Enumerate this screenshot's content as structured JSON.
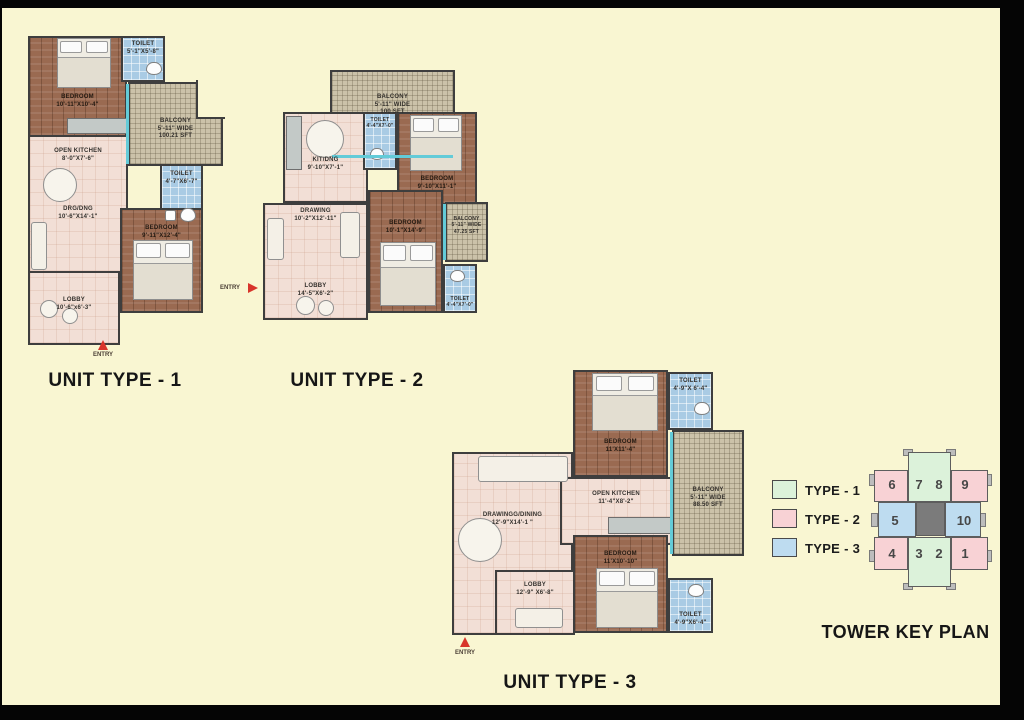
{
  "colors": {
    "bg": "#F9F6D2",
    "frame": "#050505",
    "wall": "#3E3E3E",
    "wood": "#9A6A51",
    "pink_floor": "#F2DFD6",
    "blue_floor": "#A9CBE4",
    "balcony": "#CBC2A9",
    "window_teal": "#63CBD8",
    "entry_red": "#D8352B",
    "type1": "#DCF2DA",
    "type2": "#F8D2D5",
    "type3": "#BEDCF0",
    "core": "#7B7B7B"
  },
  "u1": {
    "title": "UNIT TYPE - 1",
    "entry": "ENTRY",
    "rooms": {
      "bedroom1": {
        "label": "BEDROOM",
        "dims": "10'-11\"X10'-4\""
      },
      "toilet1": {
        "label": "TOILET",
        "dims": "5'-1\"X5'-8\""
      },
      "balcony": {
        "label": "BALCONY",
        "dims": "5'-11\" WIDE",
        "area": "100.21 SFT"
      },
      "kitchen": {
        "label": "OPEN KITCHEN",
        "dims": "8'-0\"X7'-6\""
      },
      "drgdng": {
        "label": "DRG/DNG",
        "dims": "10'-6\"X14'-1\""
      },
      "toilet2": {
        "label": "TOILET",
        "dims": "4'-7\"X6'-7\""
      },
      "bedroom2": {
        "label": "BEDROOM",
        "dims": "9'-11\"X12'-4\""
      },
      "lobby": {
        "label": "LOBBY",
        "dims": "10'-6\"x6'-3\""
      }
    }
  },
  "u2": {
    "title": "UNIT TYPE - 2",
    "entry": "ENTRY",
    "rooms": {
      "balcony_top": {
        "label": "BALCONY",
        "dims": "5'-11\" WIDE",
        "area": "100 SFT"
      },
      "kitdng": {
        "label": "KIT/DNG",
        "dims": "9'-10\"X7'-1\""
      },
      "toilet1": {
        "label": "TOILET",
        "dims": "4'-4\"X7'-0\""
      },
      "bedroom1": {
        "label": "BEDROOM",
        "dims": "9'-10\"X11'-1\""
      },
      "drawing": {
        "label": "DRAWING",
        "dims": "10'-2\"X12'-11\""
      },
      "bedroom2": {
        "label": "BEDROOM",
        "dims": "10'-1\"X14'-9\""
      },
      "balcony_right": {
        "label": "BALCONY",
        "dims": "5'-11\" WIDE",
        "area": "47.25 SFT"
      },
      "toilet2": {
        "label": "TOILET",
        "dims": "4'-4\"X7'-0\""
      },
      "lobby": {
        "label": "LOBBY",
        "dims": "14'-5\"X6'-2\""
      }
    }
  },
  "u3": {
    "title": "UNIT TYPE - 3",
    "entry": "ENTRY",
    "rooms": {
      "bedroom1": {
        "label": "BEDROOM",
        "dims": "11'X11'-4\""
      },
      "toilet1": {
        "label": "TOILET",
        "dims": "4'-9\"X 6'-4\""
      },
      "balcony": {
        "label": "BALCONY",
        "dims": "5'-11\" WIDE",
        "area": "88.50 SFT"
      },
      "kitchen": {
        "label": "OPEN KITCHEN",
        "dims": "11'-4\"X8'-2\""
      },
      "drawing": {
        "label": "DRAWINGG/DINING",
        "dims": "12'-9\"X14'-1 \""
      },
      "bedroom2": {
        "label": "BEDROOM",
        "dims": "11'X10'-10\""
      },
      "lobby": {
        "label": "LOBBY",
        "dims": "12'-9\" X6'-8\""
      },
      "toilet2": {
        "label": "TOILET",
        "dims": "4'-9\"X6'-4\""
      }
    }
  },
  "legend": {
    "items": [
      {
        "label": "TYPE - 1",
        "color": "#DCF2DA"
      },
      {
        "label": "TYPE - 2",
        "color": "#F8D2D5"
      },
      {
        "label": "TYPE - 3",
        "color": "#BEDCF0"
      }
    ]
  },
  "key_plan": {
    "title": "TOWER KEY PLAN",
    "cells": {
      "n1": "1",
      "n2": "2",
      "n3": "3",
      "n4": "4",
      "n5": "5",
      "n6": "6",
      "n7": "7",
      "n8": "8",
      "n9": "9",
      "n10": "10"
    }
  }
}
